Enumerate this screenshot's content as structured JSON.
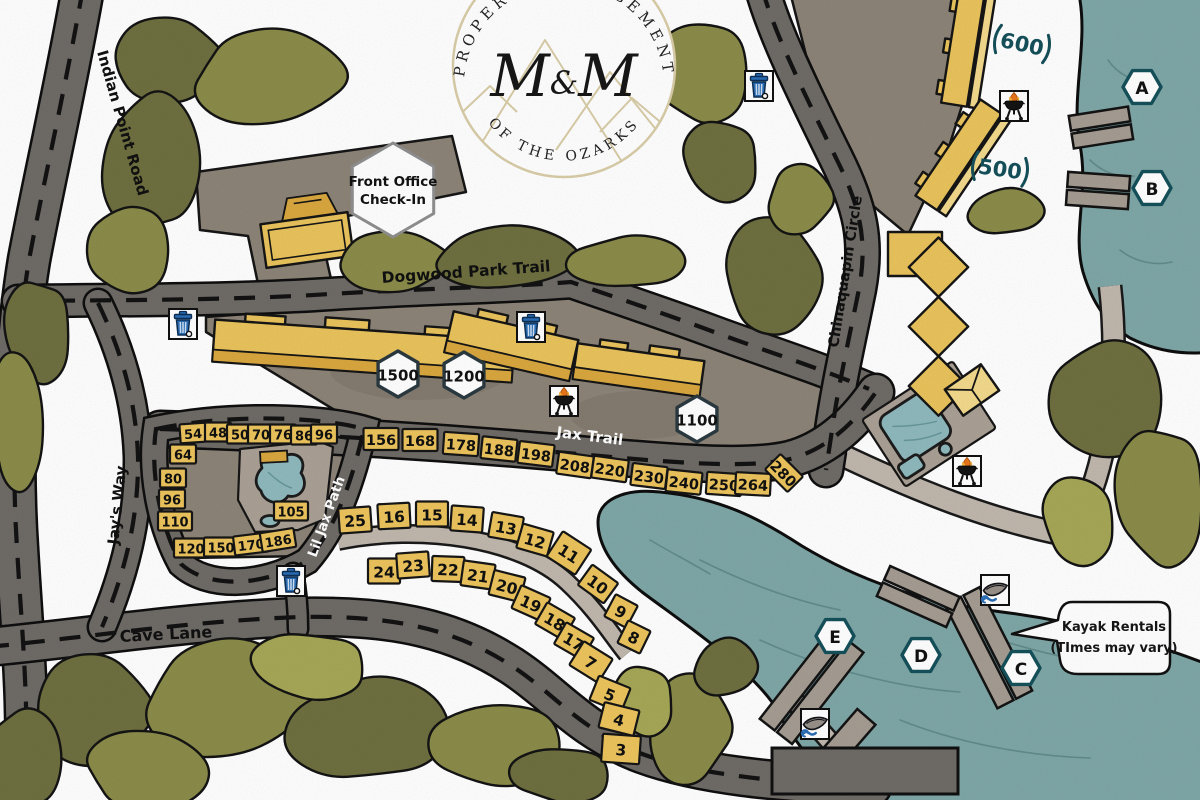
{
  "logo": {
    "arc_top": "PROPERTY MANAGEMENT",
    "monogram_left": "M",
    "monogram_amp": "&",
    "monogram_right": "M",
    "arc_bottom": "OF THE OZARKS"
  },
  "roads": {
    "indian_point": "Indian Point Road",
    "dogwood": "Dogwood Park Trail",
    "jax": "Jax Trail",
    "lil_jax": "Lil Jax Path",
    "jays_way": "Jay's Way",
    "cave": "Cave Lane",
    "chinaquapin": "Chinaquapin Circle"
  },
  "front_office": {
    "line1": "Front Office",
    "line2": "Check-In"
  },
  "upper_buildings": {
    "b600": "600",
    "b500": "500"
  },
  "kayak_note": {
    "line1": "Kayak Rentals",
    "line2": "(TImes may vary)"
  },
  "hex_badges": [
    {
      "label": "1500",
      "x": 398,
      "y": 374
    },
    {
      "label": "1200",
      "x": 464,
      "y": 375
    },
    {
      "label": "1100",
      "x": 697,
      "y": 419
    }
  ],
  "dock_badges": [
    {
      "label": "A",
      "x": 1142,
      "y": 87
    },
    {
      "label": "B",
      "x": 1152,
      "y": 188
    },
    {
      "label": "C",
      "x": 1021,
      "y": 668
    },
    {
      "label": "D",
      "x": 921,
      "y": 655
    },
    {
      "label": "E",
      "x": 835,
      "y": 636
    }
  ],
  "sites": {
    "groups": [
      {
        "name": "pool-cluster",
        "h": 19,
        "fs": 13,
        "w": {
          "1": 22,
          "2": 26,
          "3": 34
        },
        "items": [
          {
            "label": "54",
            "x": 193,
            "y": 433,
            "r": -4
          },
          {
            "label": "48",
            "x": 218,
            "y": 432,
            "r": 0
          },
          {
            "label": "50",
            "x": 240,
            "y": 434,
            "r": 0
          },
          {
            "label": "70",
            "x": 261,
            "y": 434,
            "r": 0
          },
          {
            "label": "76",
            "x": 283,
            "y": 434,
            "r": 0
          },
          {
            "label": "86",
            "x": 304,
            "y": 435,
            "r": 0
          },
          {
            "label": "96",
            "x": 324,
            "y": 434,
            "r": 0
          },
          {
            "label": "64",
            "x": 183,
            "y": 454,
            "r": 0
          },
          {
            "label": "80",
            "x": 173,
            "y": 478,
            "r": 0
          },
          {
            "label": "96",
            "x": 172,
            "y": 499,
            "r": 0
          },
          {
            "label": "110",
            "x": 175,
            "y": 521,
            "r": 0
          },
          {
            "label": "120",
            "x": 191,
            "y": 548,
            "r": 0
          },
          {
            "label": "150",
            "x": 221,
            "y": 547,
            "r": 0
          },
          {
            "label": "170",
            "x": 251,
            "y": 544,
            "r": -7
          },
          {
            "label": "186",
            "x": 278,
            "y": 540,
            "r": -9
          },
          {
            "label": "105",
            "x": 291,
            "y": 511,
            "r": 0
          }
        ]
      },
      {
        "name": "jax-row",
        "h": 22,
        "fs": 14.5,
        "w": {
          "2": 30,
          "3": 35
        },
        "items": [
          {
            "label": "156",
            "x": 381,
            "y": 439,
            "r": 0
          },
          {
            "label": "168",
            "x": 420,
            "y": 440,
            "r": 0
          },
          {
            "label": "178",
            "x": 461,
            "y": 444,
            "r": 4
          },
          {
            "label": "188",
            "x": 499,
            "y": 449,
            "r": 6
          },
          {
            "label": "198",
            "x": 536,
            "y": 454,
            "r": 7
          },
          {
            "label": "208",
            "x": 575,
            "y": 465,
            "r": 8
          },
          {
            "label": "220",
            "x": 610,
            "y": 469,
            "r": 8
          },
          {
            "label": "230",
            "x": 649,
            "y": 476,
            "r": 7
          },
          {
            "label": "240",
            "x": 684,
            "y": 482,
            "r": 6
          },
          {
            "label": "250",
            "x": 724,
            "y": 484,
            "r": 4
          },
          {
            "label": "264",
            "x": 753,
            "y": 484,
            "r": 3
          },
          {
            "label": "280",
            "x": 784,
            "y": 473,
            "r": 45,
            "w": 32,
            "h": 22
          }
        ]
      },
      {
        "name": "lower-arc",
        "h": 25,
        "fs": 15.5,
        "w": {
          "1": 25,
          "2": 32
        },
        "items": [
          {
            "label": "25",
            "x": 355,
            "y": 520,
            "r": -4
          },
          {
            "label": "16",
            "x": 394,
            "y": 516,
            "r": -3
          },
          {
            "label": "15",
            "x": 432,
            "y": 514,
            "r": 0
          },
          {
            "label": "14",
            "x": 467,
            "y": 519,
            "r": 4
          },
          {
            "label": "13",
            "x": 506,
            "y": 527,
            "r": 10
          },
          {
            "label": "12",
            "x": 535,
            "y": 540,
            "r": 16
          },
          {
            "label": "11",
            "x": 569,
            "y": 553,
            "r": 33,
            "w": 34,
            "h": 30
          },
          {
            "label": "10",
            "x": 598,
            "y": 584,
            "r": 36
          },
          {
            "label": "9",
            "x": 621,
            "y": 611,
            "r": 28
          },
          {
            "label": "8",
            "x": 634,
            "y": 637,
            "r": 26
          },
          {
            "label": "24",
            "x": 384,
            "y": 571,
            "r": 0
          },
          {
            "label": "23",
            "x": 413,
            "y": 565,
            "r": -4
          },
          {
            "label": "22",
            "x": 448,
            "y": 569,
            "r": 2
          },
          {
            "label": "21",
            "x": 478,
            "y": 575,
            "r": 8
          },
          {
            "label": "20",
            "x": 507,
            "y": 586,
            "r": 14
          },
          {
            "label": "19",
            "x": 531,
            "y": 603,
            "r": 24
          },
          {
            "label": "18",
            "x": 555,
            "y": 621,
            "r": 30
          },
          {
            "label": "17",
            "x": 574,
            "y": 641,
            "r": 30
          },
          {
            "label": "7",
            "x": 591,
            "y": 662,
            "r": 32,
            "w": 34,
            "h": 28
          },
          {
            "label": "5",
            "x": 610,
            "y": 694,
            "r": 22,
            "w": 34,
            "h": 26
          },
          {
            "label": "4",
            "x": 619,
            "y": 719,
            "r": 14,
            "w": 36,
            "h": 26
          },
          {
            "label": "3",
            "x": 621,
            "y": 749,
            "r": 4,
            "w": 38,
            "h": 28
          }
        ]
      }
    ]
  },
  "icons": [
    {
      "type": "trash",
      "x": 183,
      "y": 324
    },
    {
      "type": "trash",
      "x": 531,
      "y": 327
    },
    {
      "type": "trash",
      "x": 759,
      "y": 86
    },
    {
      "type": "trash",
      "x": 291,
      "y": 581
    },
    {
      "type": "grill",
      "x": 564,
      "y": 401
    },
    {
      "type": "grill",
      "x": 1014,
      "y": 106
    },
    {
      "type": "grill",
      "x": 967,
      "y": 471
    },
    {
      "type": "kayak",
      "x": 815,
      "y": 724
    },
    {
      "type": "kayak",
      "x": 995,
      "y": 590
    }
  ],
  "colors": {
    "lake": "#7fa7a7",
    "road": "#6f6b67",
    "building_yellow": "#e9c35c",
    "plate_yellow": "#ecc45d",
    "badge_border": "#15505a",
    "logo_tan": "#d9cda8"
  }
}
